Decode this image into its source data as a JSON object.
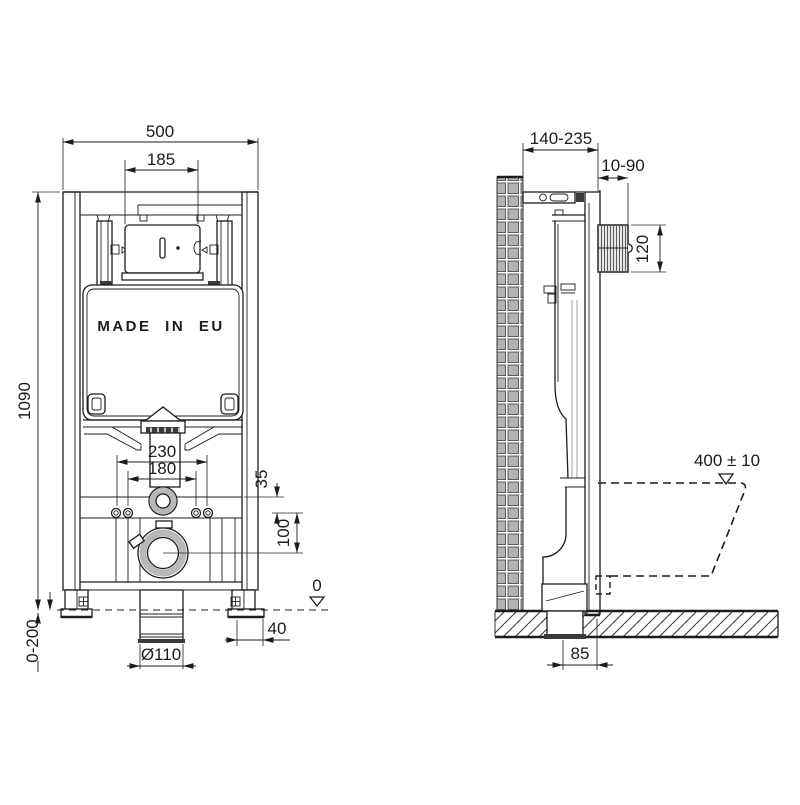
{
  "front_view": {
    "tank_label": "MADE IN EU",
    "dims": {
      "overall_width": "500",
      "flush_window_width": "185",
      "overall_height": "1090",
      "fixing_spread_outer": "230",
      "fixing_spread_inner": "180",
      "supply_offset": "35",
      "outlet_drop": "100",
      "floor_level": "0",
      "foot_offset": "40",
      "leg_adjustment": "0-200",
      "outlet_diameter": "Ø110"
    }
  },
  "side_view": {
    "dims": {
      "frame_depth": "140-235",
      "actuator_depth": "10-90",
      "actuator_height": "120",
      "bowl_rim_height": "400 ± 10",
      "outlet_offset": "85"
    }
  },
  "colors": {
    "line": "#1c1c1c",
    "tile": "#b3b3b3",
    "engraving": "#8a8a8a"
  }
}
